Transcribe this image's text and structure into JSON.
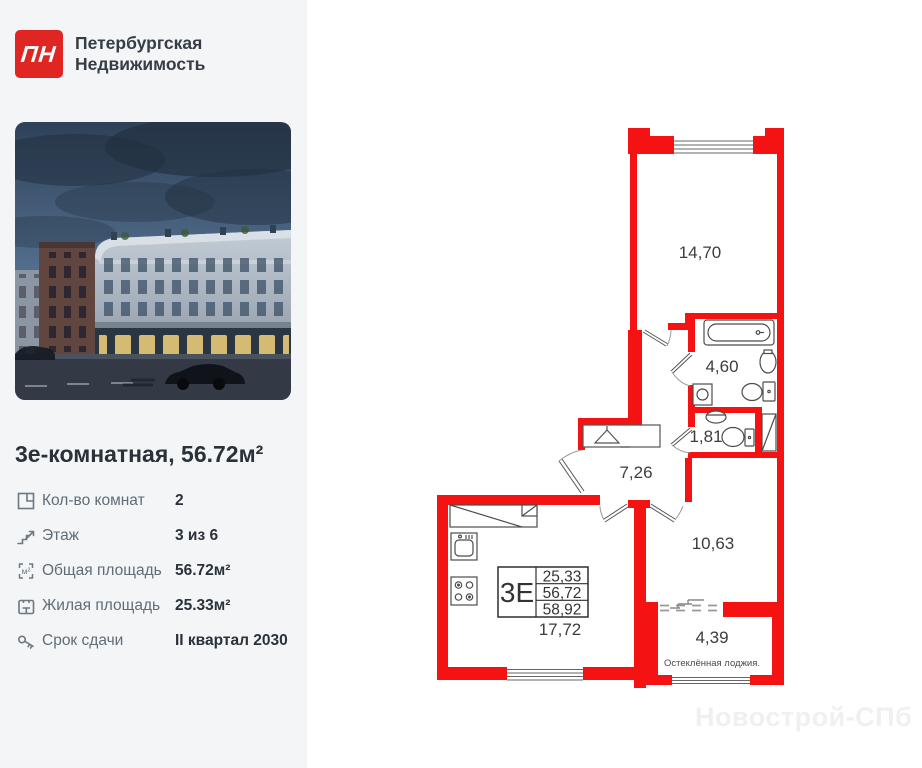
{
  "brand": {
    "mark": "ПН",
    "line1": "Петербургская",
    "line2": "Недвижимость"
  },
  "listing": {
    "title": "3е-комнатная, 56.72м²",
    "details": [
      {
        "icon": "rooms-icon",
        "label": "Кол-во комнат",
        "value": "2"
      },
      {
        "icon": "stairs-icon",
        "label": "Этаж",
        "value": "3 из 6"
      },
      {
        "icon": "total-area-icon",
        "label": "Общая площадь",
        "value": "56.72м²"
      },
      {
        "icon": "living-area-icon",
        "label": "Жилая площадь",
        "value": "25.33м²"
      },
      {
        "icon": "key-icon",
        "label": "Срок сдачи",
        "value": "II квартал 2030"
      }
    ]
  },
  "floor_plan": {
    "rooms": [
      {
        "name": "living-room",
        "area": "14,70"
      },
      {
        "name": "bathroom",
        "area": "4,60"
      },
      {
        "name": "wc",
        "area": "1,81"
      },
      {
        "name": "hallway",
        "area": "7,26"
      },
      {
        "name": "bedroom",
        "area": "10,63"
      },
      {
        "name": "kitchen-living",
        "area": "17,72"
      },
      {
        "name": "loggia",
        "area": "4,39",
        "note": "Остеклённая лоджия."
      }
    ],
    "unit_table": {
      "label": "3Е",
      "living_area": "25,33",
      "area_no_loggia": "56,72",
      "area_with_loggia": "58,92"
    }
  },
  "colors": {
    "brand_red": "#e02622",
    "wall_red": "#f41212",
    "sidebar_bg": "#f3f5f7",
    "watermark": "#f0f0f0"
  },
  "watermark": {
    "text": "Новострой-СПб"
  }
}
